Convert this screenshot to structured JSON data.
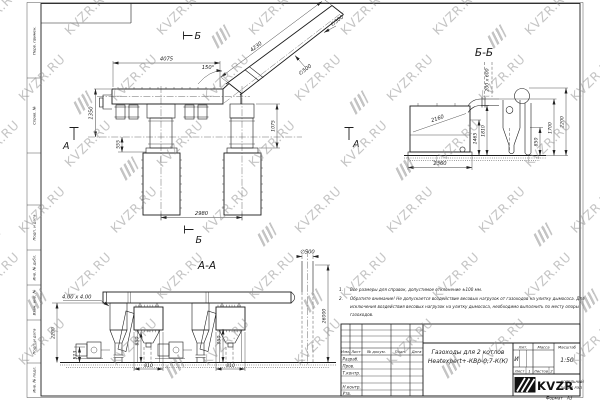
{
  "watermark": {
    "text": "KVZR.RU"
  },
  "margin": {
    "cells": [
      "Перв. примен.",
      "Справ. №",
      "Подп. и дата",
      "Инв. № дубл.",
      "Взам. инв. №",
      "Подп. и дата",
      "Инв. № подл."
    ]
  },
  "main_view": {
    "marker_b_top": "Б",
    "marker_b_bottom": "Б",
    "marker_a": "А",
    "dim_4075": "4075",
    "dim_4230": "4230",
    "dim_angle": "150°",
    "dim_d500_1": "∅500",
    "dim_d500_2": "∅500",
    "dim_1350": "1350",
    "dim_555": "555",
    "dim_1075": "1075",
    "dim_2980": "2980"
  },
  "bb_view": {
    "label": "Б-Б",
    "marker_a": "А",
    "dim_200x600": "200 x 600",
    "dim_2160": "2160",
    "dim_2360": "2360",
    "dim_1465": "1465",
    "dim_1810": "1810",
    "dim_850": "850",
    "dim_1700": "1700",
    "dim_2200": "2200"
  },
  "aa_view": {
    "label": "А-А",
    "dim_duct": "4.00 x 4.00",
    "dim_2200": "2200",
    "dim_513": "513",
    "dim_850": "850",
    "dim_810_1": "810",
    "dim_950": "950",
    "dim_810_2": "810",
    "dim_d500": "∅500",
    "dim_26000": "26000"
  },
  "notes": {
    "n1_num": "1.",
    "n1_text": "Все размеры для справок, допустимое отклонение ±100 мм.",
    "n2_num": "2.",
    "n2_line1": "Обратите внимание! Не допускается воздействие весовых нагрузок от газоходов на улитку дымососа. Для",
    "n2_line2": "исключения воздействия весовых нагрузок на улитку дымососа, необходимо выполнить по месту опоры",
    "n2_line3": "газоходов."
  },
  "title_block": {
    "col_izm": "Изм.",
    "col_list": "Лист",
    "col_doc": "№ докум.",
    "col_podp": "Подп.",
    "col_data": "Дата",
    "row_razrab": "Разраб.",
    "row_prov": "Пров.",
    "row_tkontr": "Т.контр.",
    "row_nkontr": "Н.контр.",
    "row_utv": "Утв.",
    "title_line1": "Газоходы для 2 котлов",
    "title_line2": "Heatexpert+-КВр-0,7-К(К)",
    "hdr_lit": "Лит.",
    "hdr_massa": "Масса",
    "hdr_masshtab": "Масштаб",
    "lit_value": "И",
    "scale_value": "1:50",
    "sheet_label": "Лист",
    "sheet_value": "1",
    "sheets_label": "Листов",
    "sheets_value": "2",
    "logo_text": "KVZR",
    "company_line1": "КОТЕЛЬНЫЙ",
    "company_line2": "ЗАВОД РЭП",
    "format_label": "Формат",
    "format_value": "А3"
  }
}
